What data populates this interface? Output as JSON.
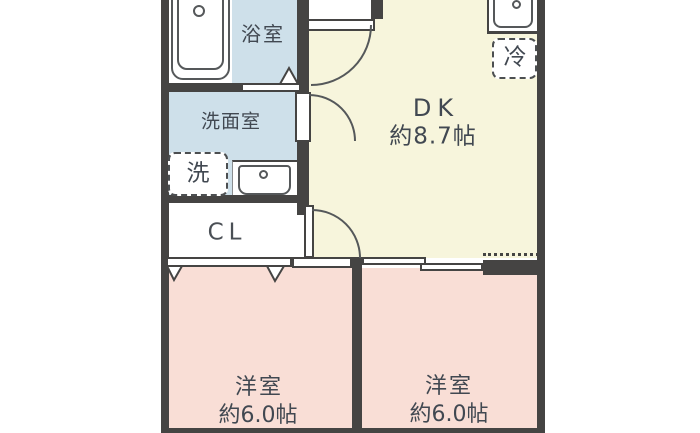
{
  "rooms": {
    "bath": {
      "label": "浴室"
    },
    "wash": {
      "label": "洗面室"
    },
    "closet": {
      "label": "CL"
    },
    "dk": {
      "label": "DK",
      "area": "約8.7帖"
    },
    "west_left": {
      "label": "洋室",
      "area": "約6.0帖"
    },
    "west_right": {
      "label": "洋室",
      "area": "約6.0帖"
    }
  },
  "fixtures": {
    "washer": {
      "label": "洗"
    },
    "fridge": {
      "label": "冷"
    }
  },
  "colors": {
    "wall": "#454443",
    "wet_floor": "#cee0ea",
    "dk_floor": "#f7f5dc",
    "bedroom_floor": "#f9ded6",
    "fixture_outline": "#55585a",
    "label_text": "#414851"
  }
}
